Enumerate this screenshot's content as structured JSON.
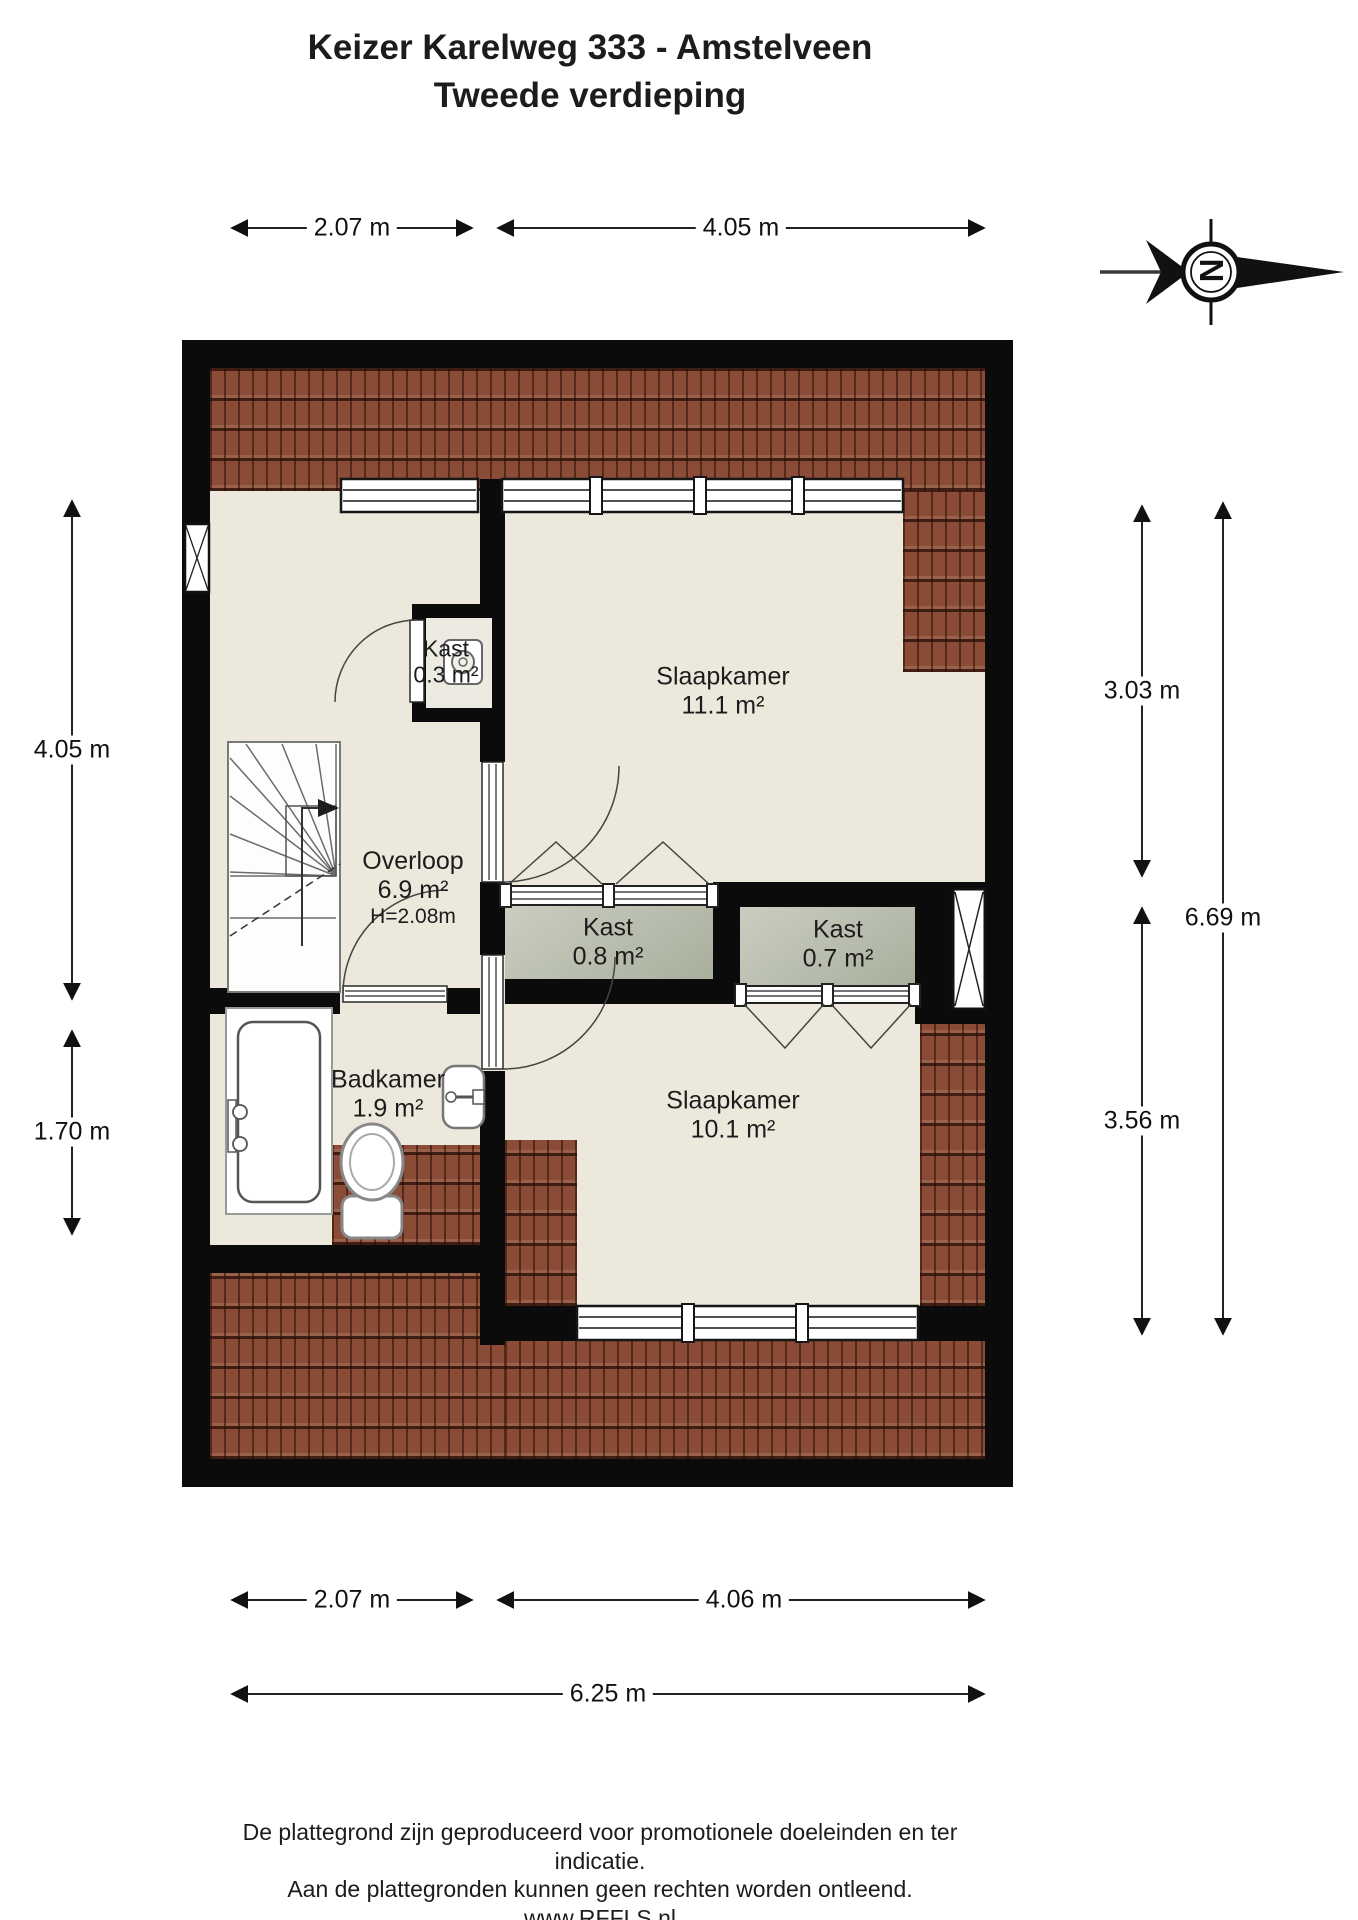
{
  "title": {
    "line1": "Keizer Karelweg 333 - Amstelveen",
    "line2": "Tweede verdieping"
  },
  "compass": {
    "letter": "N"
  },
  "dimensions": {
    "top": {
      "left": "2.07 m",
      "right": "4.05 m"
    },
    "left": {
      "top": "4.05 m",
      "bottom": "1.70 m"
    },
    "right": {
      "top": "3.03 m",
      "total": "6.69 m",
      "bottom": "3.56 m"
    },
    "bottom": {
      "left": "2.07 m",
      "right": "4.06 m",
      "total": "6.25 m"
    }
  },
  "rooms": {
    "slaapkamer_noord": {
      "name": "Slaapkamer",
      "area": "11.1 m²"
    },
    "kast_cv": {
      "name": "Kast",
      "area": "0.3 m²"
    },
    "overloop": {
      "name": "Overloop",
      "area": "6.9 m²",
      "ceiling_height": "H=2.08m"
    },
    "kast_midden": {
      "name": "Kast",
      "area": "0.8 m²"
    },
    "kast_oost": {
      "name": "Kast",
      "area": "0.7 m²"
    },
    "badkamer": {
      "name": "Badkamer",
      "area": "1.9 m²"
    },
    "slaapkamer_zuid": {
      "name": "Slaapkamer",
      "area": "10.1 m²"
    }
  },
  "footer": {
    "line1": "De plattegrond zijn geproduceerd voor promotionele doeleinden en ter indicatie.",
    "line2": "Aan de plattegronden kunnen geen rechten worden ontleend.",
    "line3": "www.RFFLS.nl"
  },
  "colors": {
    "wall": "#0b0b0b",
    "floor": "#ece8dc",
    "closet": "#b8bdae",
    "roof": "#8a4c36"
  }
}
